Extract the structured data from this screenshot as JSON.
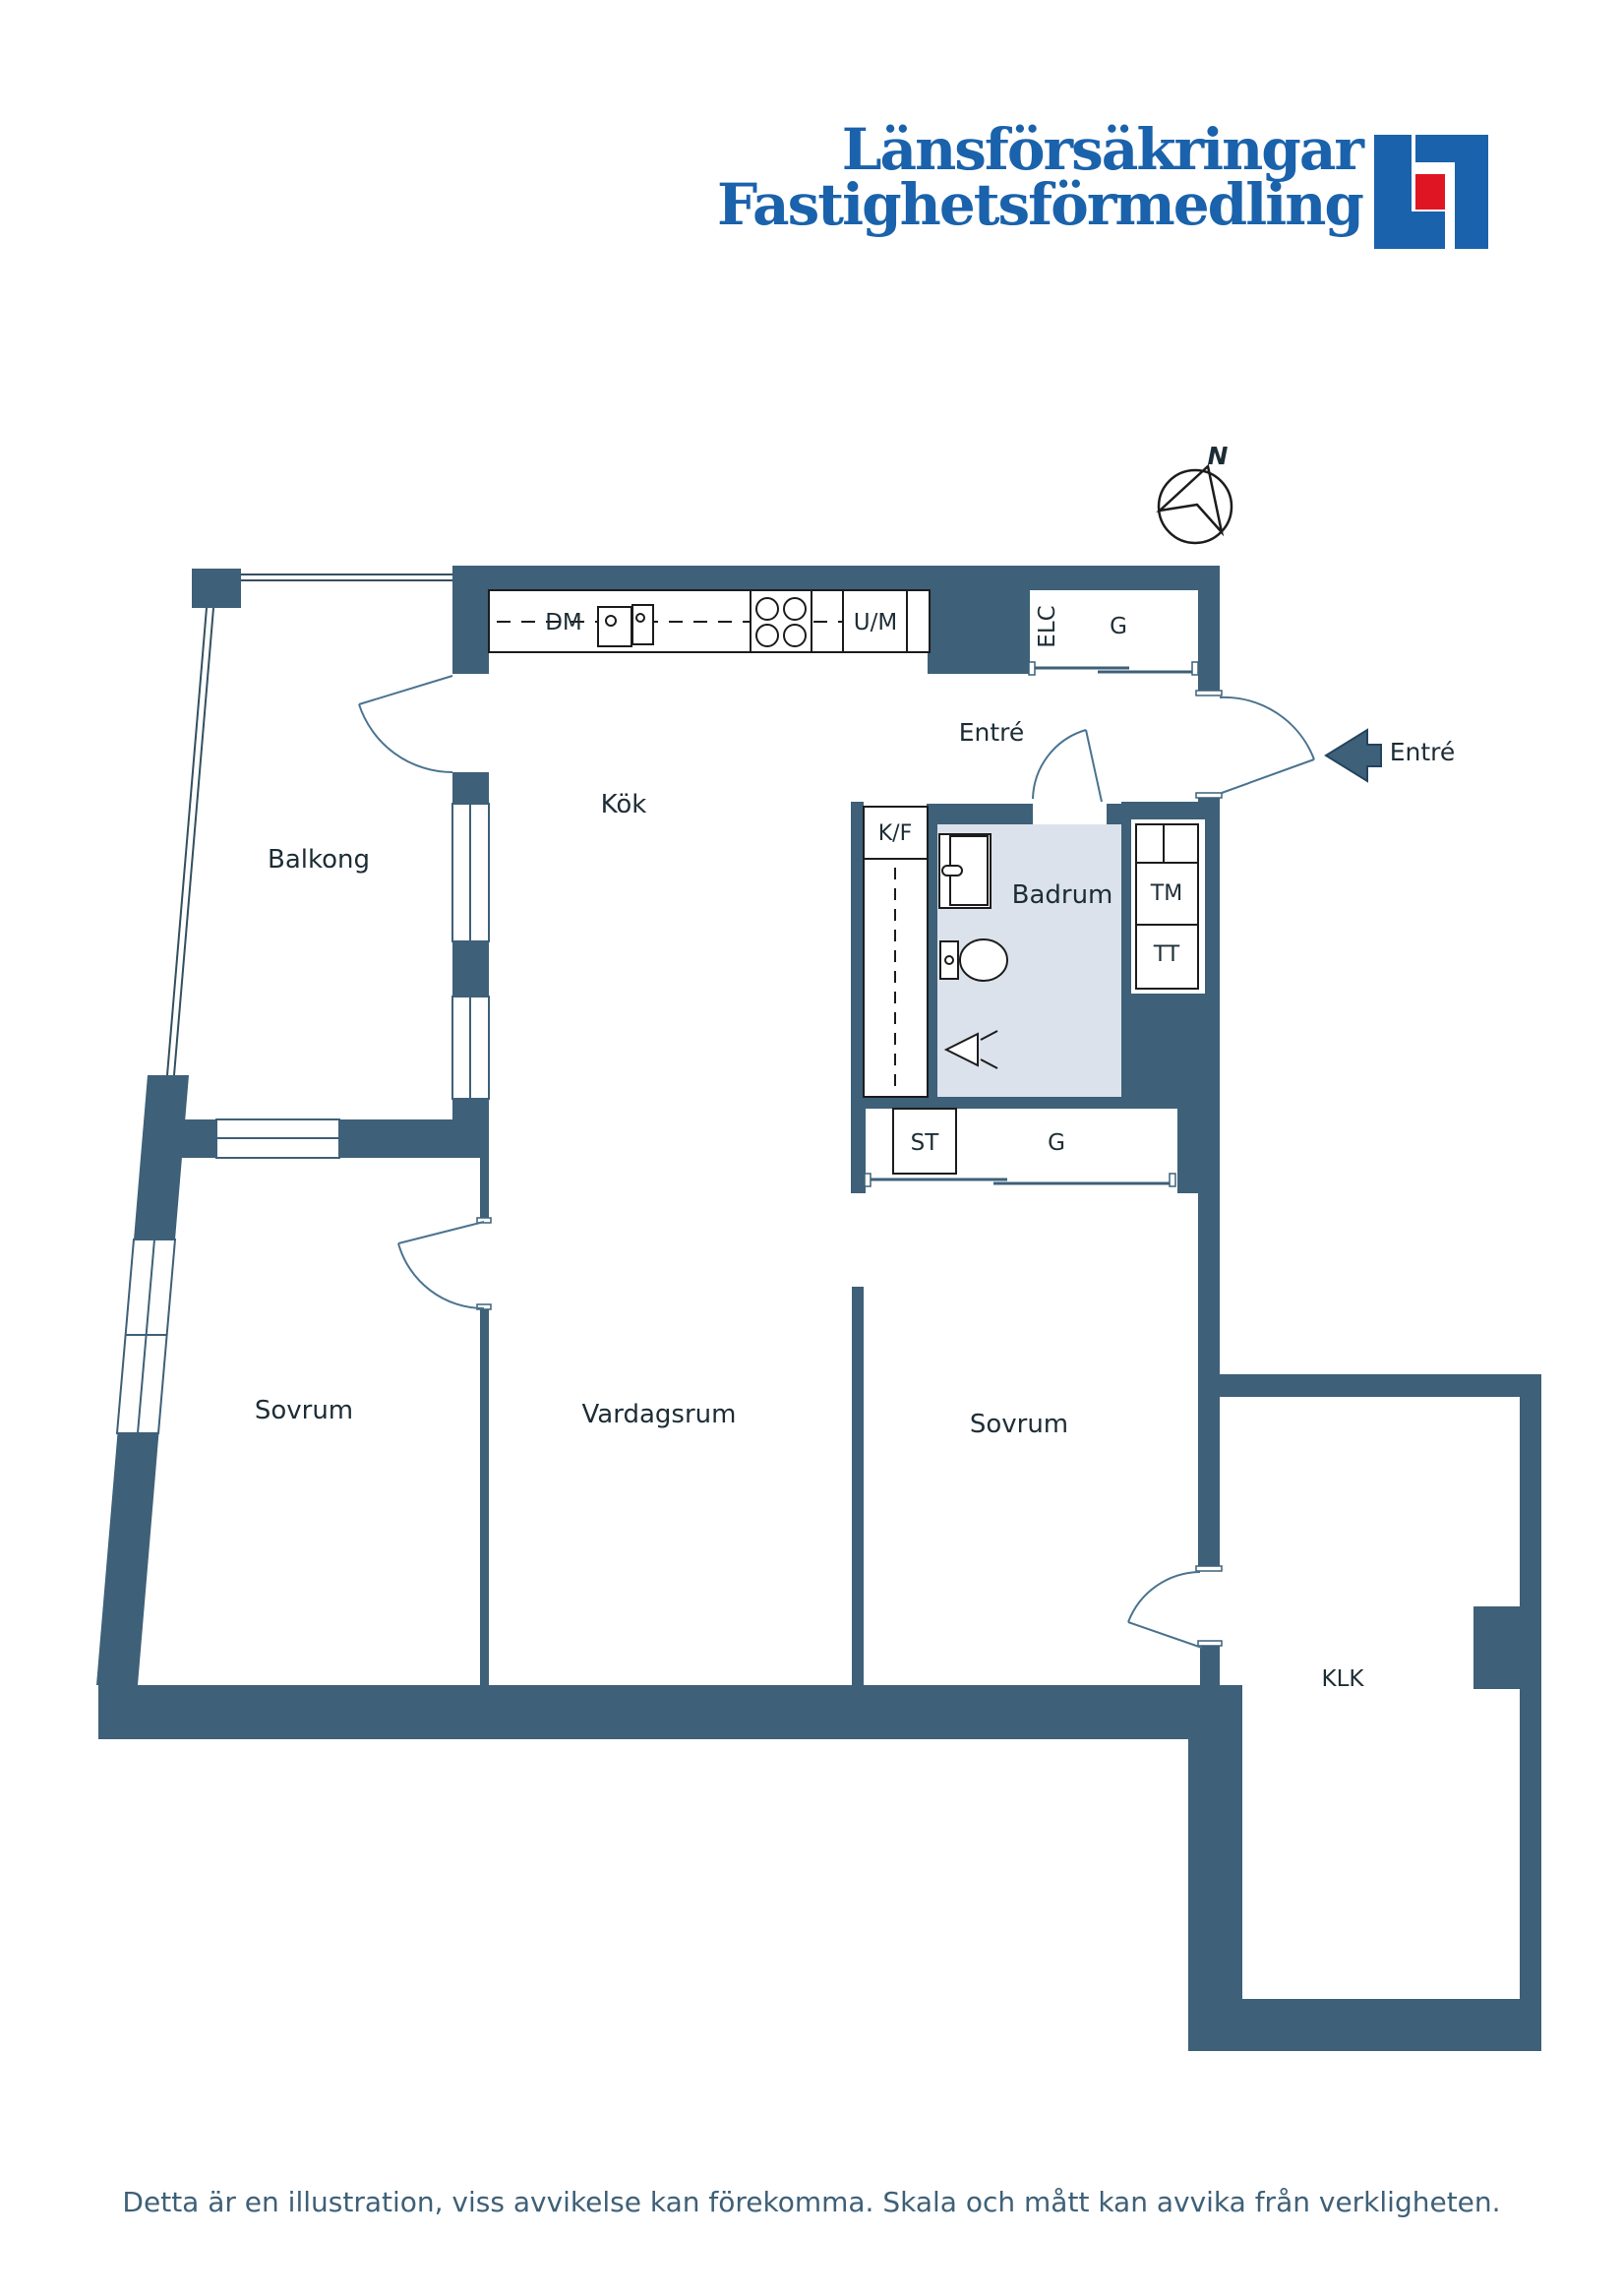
{
  "branding": {
    "line1": "Länsförsäkringar",
    "line2": "Fastighetsförmedling"
  },
  "compass": {
    "north_label": "N"
  },
  "entry": {
    "label_inside": "Entré",
    "label_outside": "Entré"
  },
  "rooms": {
    "balkong": {
      "label": "Balkong"
    },
    "kok": {
      "label": "Kök"
    },
    "badrum": {
      "label": "Badrum"
    },
    "sovrum_left": {
      "label": "Sovrum"
    },
    "vardagsrum": {
      "label": "Vardagsrum"
    },
    "sovrum_right": {
      "label": "Sovrum"
    },
    "klk": {
      "label": "KLK"
    }
  },
  "fixtures": {
    "dishwasher": "DM",
    "oven_micro": "U/M",
    "electrical": "ELC",
    "wardrobe_top": "G",
    "fridge_freezer": "K/F",
    "washing_machine": "TM",
    "dryer": "TT",
    "cleaning_closet": "ST",
    "wardrobe_lower": "G"
  },
  "footer": {
    "disclaimer": "Detta är en illustration, viss avvikelse kan förekomma. Skala och mått kan avvika från verkligheten."
  },
  "colors": {
    "wall": "#3e6078",
    "bath-floor": "#dbe2ec",
    "line": "#33505f",
    "door": "#4a7390",
    "logo-blue": "#1a62ab",
    "logo-red": "#e01523",
    "footer-text": "#3e6078"
  }
}
